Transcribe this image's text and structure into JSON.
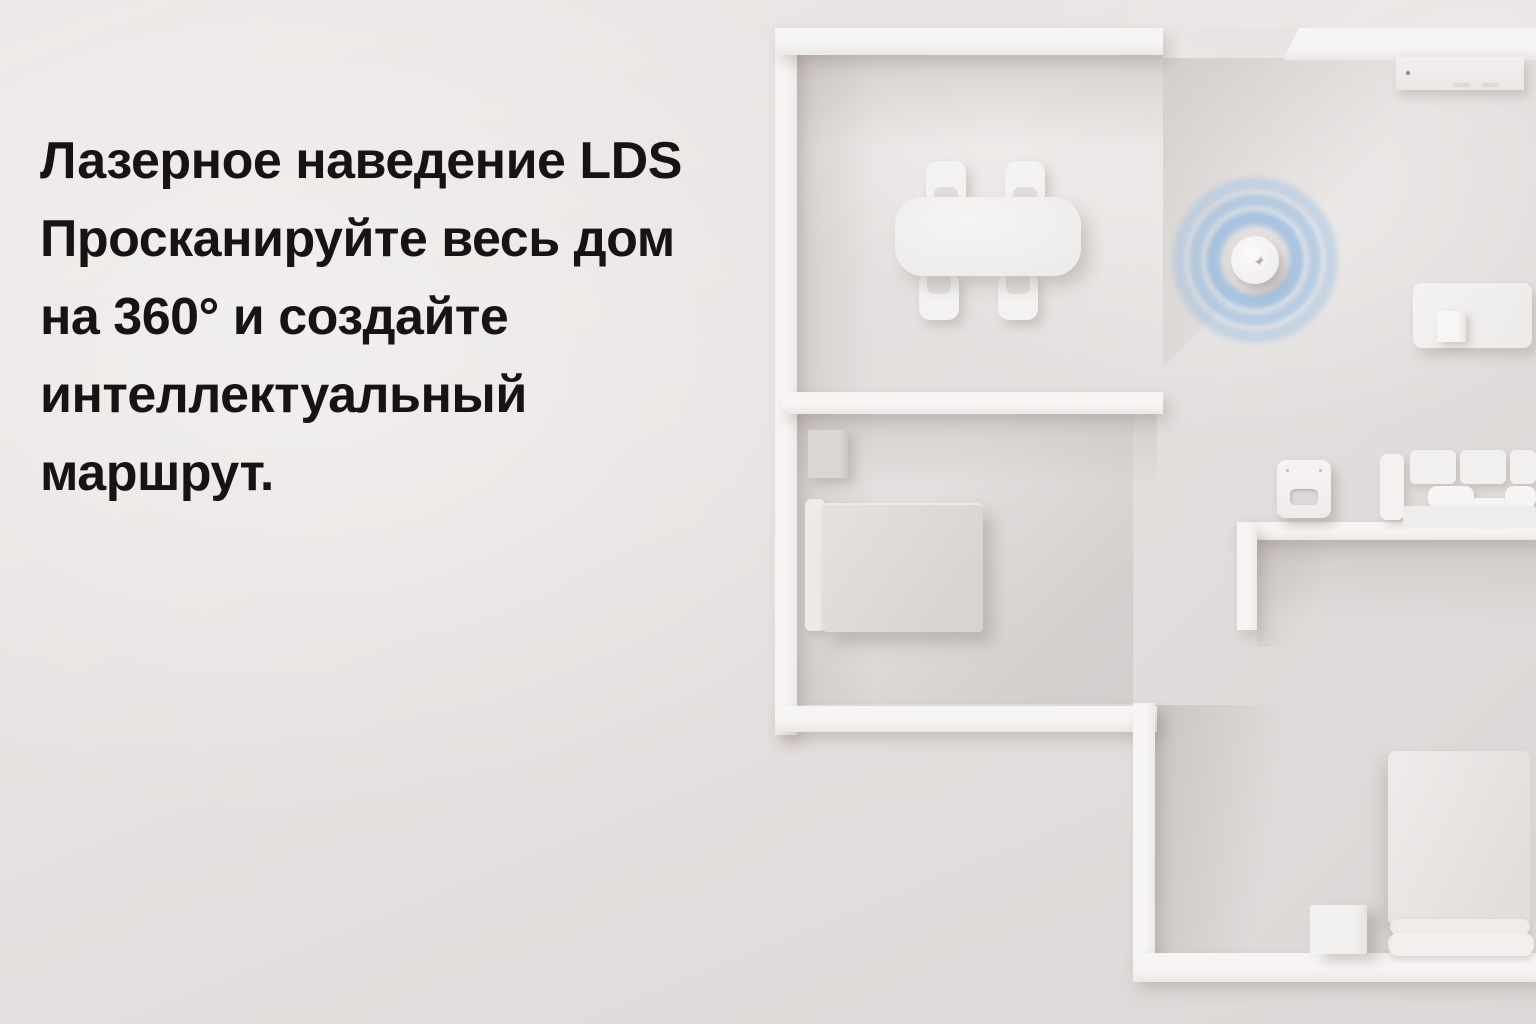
{
  "headline": {
    "lines": [
      "Лазерное наведение LDS",
      "Просканируйте весь дом",
      "на 360° и создайте",
      "интеллектуальный",
      "маршрут."
    ],
    "color": "#171314"
  },
  "colors": {
    "background": "#e7e2e1",
    "wall": "#f5f3f2",
    "floor": "#e2dedd",
    "furniture_white": "#f3f1f0",
    "radar_ring_blue": "#9cbfe2",
    "text": "#171314"
  },
  "floorplan": {
    "objects": [
      "dining-table",
      "dining-chair",
      "robot-vacuum",
      "radar-rings",
      "tv-console",
      "side-table",
      "sofa",
      "charging-dock",
      "nightstand",
      "bed",
      "double-bed",
      "storage-cube"
    ]
  }
}
